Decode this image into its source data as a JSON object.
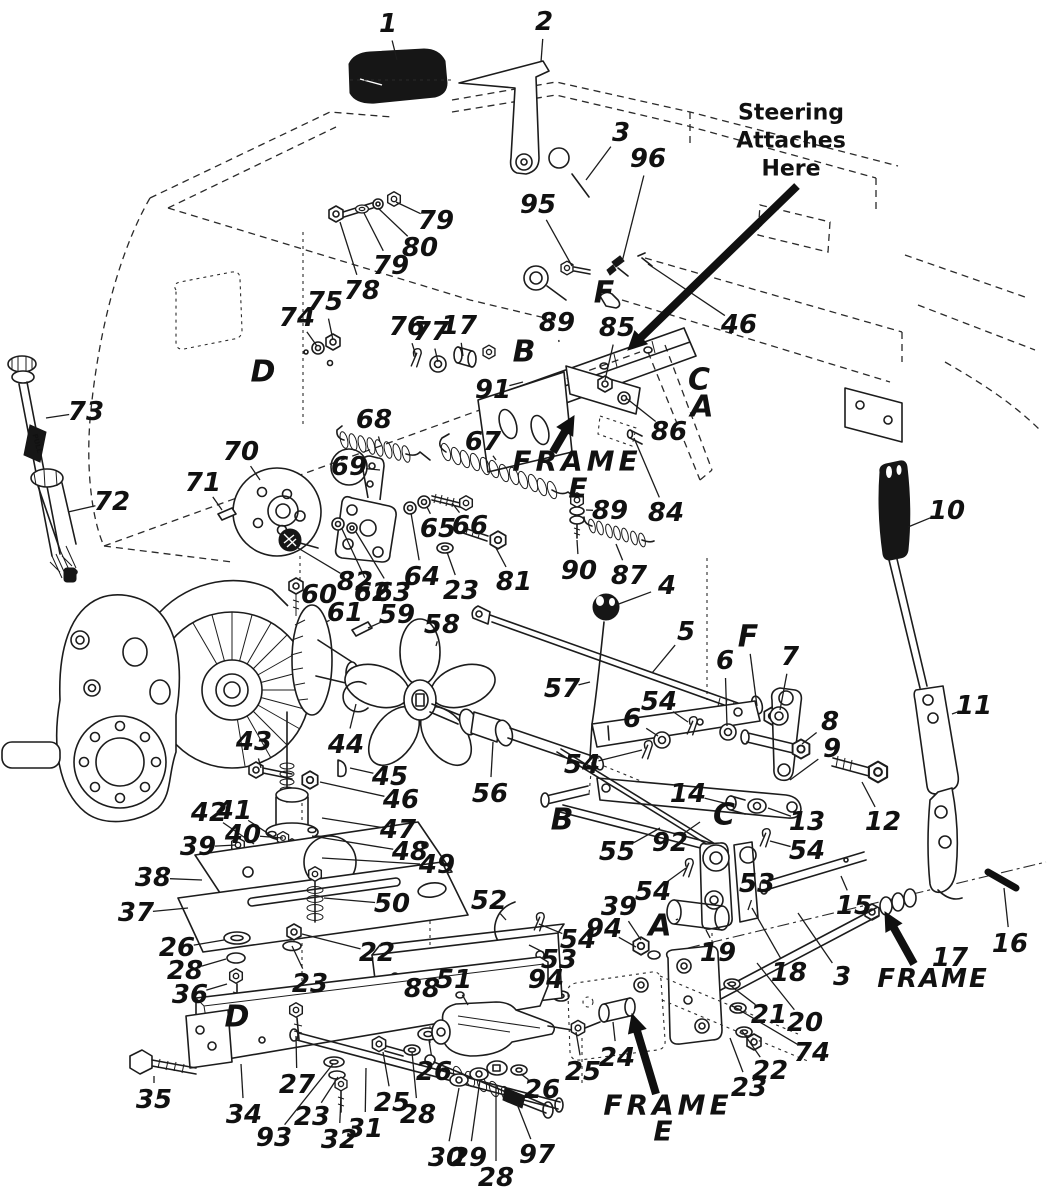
{
  "meta": {
    "doc_type": "exploded-parts-diagram",
    "subject": "tractor drive and speed control linkage",
    "paper_color": "#ffffff",
    "ink_color": "#1c1c1c"
  },
  "extra": {
    "dipstick_tag": "PULL"
  },
  "notes": [
    {
      "id": "steering-note",
      "size": 22,
      "italic": false,
      "spacing": 0,
      "lines": [
        {
          "t": "Steering",
          "x": 791,
          "y": 113
        },
        {
          "t": "Attaches",
          "x": 791,
          "y": 141
        },
        {
          "t": "Here",
          "x": 791,
          "y": 169
        }
      ],
      "arrow": [
        797,
        186,
        628,
        350
      ]
    },
    {
      "id": "frame-e-upper",
      "size": 28,
      "italic": true,
      "spacing": 4,
      "lines": [
        {
          "t": "FRAME",
          "x": 577,
          "y": 461
        },
        {
          "t": "E",
          "x": 580,
          "y": 488
        }
      ],
      "arrow": [
        553,
        452,
        574,
        416
      ]
    },
    {
      "id": "frame-right",
      "size": 26,
      "italic": true,
      "spacing": 2,
      "lines": [
        {
          "t": "FRAME",
          "x": 933,
          "y": 979
        }
      ],
      "arrow": [
        914,
        964,
        885,
        912
      ]
    },
    {
      "id": "frame-e-lower",
      "size": 28,
      "italic": true,
      "spacing": 4,
      "lines": [
        {
          "t": "FRAME",
          "x": 668,
          "y": 1105
        },
        {
          "t": "E",
          "x": 665,
          "y": 1131
        }
      ],
      "arrow": [
        656,
        1094,
        632,
        1014
      ]
    }
  ],
  "ref_letters": [
    {
      "t": "D",
      "x": 263,
      "y": 372
    },
    {
      "t": "B",
      "x": 524,
      "y": 352
    },
    {
      "t": "F",
      "x": 604,
      "y": 293
    },
    {
      "t": "C",
      "x": 699,
      "y": 380
    },
    {
      "t": "A",
      "x": 702,
      "y": 407
    },
    {
      "t": "F",
      "x": 748,
      "y": 637,
      "lead": [
        757,
        706
      ]
    },
    {
      "t": "B",
      "x": 562,
      "y": 820
    },
    {
      "t": "C",
      "x": 724,
      "y": 815
    },
    {
      "t": "A",
      "x": 660,
      "y": 926,
      "lead": [
        678,
        919
      ]
    },
    {
      "t": "D",
      "x": 237,
      "y": 1017
    }
  ],
  "circled": [
    {
      "t": "69",
      "x": 349,
      "y": 467,
      "lead": [
        380,
        470
      ]
    }
  ],
  "part_labels": [
    {
      "t": "1",
      "x": 388,
      "y": 24,
      "lead": [
        397,
        60
      ]
    },
    {
      "t": "2",
      "x": 544,
      "y": 22,
      "lead": [
        541,
        62
      ]
    },
    {
      "t": "3",
      "x": 621,
      "y": 133,
      "lead": [
        586,
        180
      ]
    },
    {
      "t": "96",
      "x": 648,
      "y": 159,
      "lead": [
        622,
        262
      ]
    },
    {
      "t": "95",
      "x": 538,
      "y": 205,
      "lead": [
        572,
        266
      ]
    },
    {
      "t": "79",
      "x": 436,
      "y": 221,
      "lead": [
        396,
        202
      ]
    },
    {
      "t": "80",
      "x": 420,
      "y": 248,
      "lead": [
        378,
        208
      ]
    },
    {
      "t": "79",
      "x": 391,
      "y": 266,
      "lead": [
        364,
        213
      ]
    },
    {
      "t": "78",
      "x": 362,
      "y": 291,
      "lead": [
        340,
        222
      ]
    },
    {
      "t": "75",
      "x": 325,
      "y": 302,
      "lead": [
        333,
        340
      ]
    },
    {
      "t": "74",
      "x": 297,
      "y": 318,
      "lead": [
        317,
        346
      ]
    },
    {
      "t": "76",
      "x": 407,
      "y": 327,
      "lead": [
        416,
        356
      ]
    },
    {
      "t": "77",
      "x": 431,
      "y": 332,
      "lead": [
        438,
        362
      ]
    },
    {
      "t": "17",
      "x": 459,
      "y": 326,
      "lead": [
        463,
        356
      ]
    },
    {
      "t": "89",
      "x": 557,
      "y": 323,
      "lead": [
        559,
        342
      ]
    },
    {
      "t": "85",
      "x": 617,
      "y": 328,
      "lead": [
        605,
        380
      ]
    },
    {
      "t": "46",
      "x": 739,
      "y": 325,
      "lead": [
        648,
        264
      ]
    },
    {
      "t": "91",
      "x": 493,
      "y": 390,
      "lead": [
        523,
        382
      ]
    },
    {
      "t": "86",
      "x": 669,
      "y": 432,
      "lead": [
        626,
        398
      ]
    },
    {
      "t": "73",
      "x": 86,
      "y": 412,
      "lead": [
        46,
        418
      ]
    },
    {
      "t": "68",
      "x": 374,
      "y": 420,
      "lead": [
        380,
        442
      ]
    },
    {
      "t": "67",
      "x": 483,
      "y": 442,
      "lead": [
        496,
        460
      ]
    },
    {
      "t": "70",
      "x": 241,
      "y": 452,
      "lead": [
        260,
        480
      ]
    },
    {
      "t": "71",
      "x": 203,
      "y": 483,
      "lead": [
        222,
        510
      ]
    },
    {
      "t": "72",
      "x": 112,
      "y": 502,
      "lead": [
        68,
        512
      ]
    },
    {
      "t": "84",
      "x": 666,
      "y": 513,
      "lead": [
        634,
        438
      ]
    },
    {
      "t": "89",
      "x": 610,
      "y": 511,
      "lead": [
        586,
        510
      ]
    },
    {
      "t": "90",
      "x": 579,
      "y": 571,
      "lead": [
        577,
        540
      ]
    },
    {
      "t": "87",
      "x": 629,
      "y": 576,
      "lead": [
        616,
        544
      ]
    },
    {
      "t": "10",
      "x": 947,
      "y": 511,
      "lead": [
        908,
        527
      ]
    },
    {
      "t": "65",
      "x": 438,
      "y": 529,
      "lead": [
        427,
        507
      ]
    },
    {
      "t": "66",
      "x": 470,
      "y": 526,
      "lead": [
        452,
        503
      ]
    },
    {
      "t": "64",
      "x": 422,
      "y": 577,
      "lead": [
        411,
        513
      ]
    },
    {
      "t": "23",
      "x": 461,
      "y": 591,
      "lead": [
        447,
        552
      ]
    },
    {
      "t": "81",
      "x": 514,
      "y": 582,
      "lead": [
        496,
        548
      ]
    },
    {
      "t": "82",
      "x": 355,
      "y": 582,
      "lead": [
        298,
        548
      ]
    },
    {
      "t": "62",
      "x": 372,
      "y": 593,
      "lead": [
        342,
        529
      ]
    },
    {
      "t": "63",
      "x": 393,
      "y": 593,
      "lead": [
        356,
        532
      ]
    },
    {
      "t": "60",
      "x": 319,
      "y": 595,
      "lead": [
        302,
        594
      ]
    },
    {
      "t": "61",
      "x": 345,
      "y": 613,
      "lead": [
        326,
        622
      ]
    },
    {
      "t": "59",
      "x": 397,
      "y": 615,
      "lead": [
        368,
        628
      ]
    },
    {
      "t": "58",
      "x": 442,
      "y": 625,
      "lead": [
        436,
        646
      ]
    },
    {
      "t": "4",
      "x": 667,
      "y": 586,
      "lead": [
        616,
        605
      ]
    },
    {
      "t": "5",
      "x": 686,
      "y": 632,
      "lead": [
        652,
        673
      ]
    },
    {
      "t": "57",
      "x": 562,
      "y": 689,
      "lead": [
        590,
        682
      ]
    },
    {
      "t": "6",
      "x": 725,
      "y": 661,
      "lead": [
        727,
        726
      ]
    },
    {
      "t": "7",
      "x": 790,
      "y": 657,
      "lead": [
        780,
        710
      ]
    },
    {
      "t": "54",
      "x": 659,
      "y": 702,
      "lead": [
        688,
        722
      ]
    },
    {
      "t": "6",
      "x": 632,
      "y": 719,
      "lead": [
        658,
        736
      ]
    },
    {
      "t": "8",
      "x": 830,
      "y": 722,
      "lead": [
        802,
        744
      ]
    },
    {
      "t": "9",
      "x": 832,
      "y": 749,
      "lead": [
        790,
        780
      ]
    },
    {
      "t": "11",
      "x": 974,
      "y": 706,
      "lead": [
        952,
        714
      ]
    },
    {
      "t": "54",
      "x": 582,
      "y": 765,
      "lead": [
        642,
        750
      ]
    },
    {
      "t": "14",
      "x": 688,
      "y": 794,
      "lead": [
        728,
        804
      ]
    },
    {
      "t": "13",
      "x": 807,
      "y": 822,
      "lead": [
        768,
        808
      ]
    },
    {
      "t": "12",
      "x": 883,
      "y": 822,
      "lead": [
        862,
        782
      ]
    },
    {
      "t": "56",
      "x": 490,
      "y": 794,
      "lead": [
        493,
        742
      ]
    },
    {
      "t": "55",
      "x": 617,
      "y": 852,
      "lead": [
        660,
        828
      ]
    },
    {
      "t": "92",
      "x": 670,
      "y": 843,
      "lead": [
        700,
        822
      ]
    },
    {
      "t": "43",
      "x": 254,
      "y": 742,
      "lead": [
        261,
        768
      ]
    },
    {
      "t": "44",
      "x": 346,
      "y": 745,
      "lead": [
        356,
        704
      ]
    },
    {
      "t": "45",
      "x": 390,
      "y": 777,
      "lead": [
        350,
        768
      ]
    },
    {
      "t": "46",
      "x": 401,
      "y": 800,
      "lead": [
        320,
        782
      ]
    },
    {
      "t": "42",
      "x": 209,
      "y": 813,
      "lead": [
        254,
        844
      ]
    },
    {
      "t": "41",
      "x": 234,
      "y": 811,
      "lead": [
        278,
        840
      ]
    },
    {
      "t": "40",
      "x": 243,
      "y": 835,
      "lead": [
        283,
        838
      ]
    },
    {
      "t": "39",
      "x": 198,
      "y": 847,
      "lead": [
        236,
        845
      ]
    },
    {
      "t": "47",
      "x": 398,
      "y": 830,
      "lead": [
        322,
        818
      ]
    },
    {
      "t": "48",
      "x": 410,
      "y": 852,
      "lead": [
        312,
        836
      ]
    },
    {
      "t": "49",
      "x": 437,
      "y": 865,
      "lead": [
        322,
        858
      ]
    },
    {
      "t": "38",
      "x": 153,
      "y": 878,
      "lead": [
        202,
        880
      ]
    },
    {
      "t": "37",
      "x": 136,
      "y": 913,
      "lead": [
        188,
        908
      ]
    },
    {
      "t": "50",
      "x": 392,
      "y": 904,
      "lead": [
        324,
        898
      ]
    },
    {
      "t": "26",
      "x": 177,
      "y": 948,
      "lead": [
        224,
        940
      ]
    },
    {
      "t": "28",
      "x": 185,
      "y": 971,
      "lead": [
        226,
        959
      ]
    },
    {
      "t": "36",
      "x": 190,
      "y": 995,
      "lead": [
        227,
        984
      ]
    },
    {
      "t": "22",
      "x": 377,
      "y": 953,
      "lead": [
        302,
        934
      ]
    },
    {
      "t": "23",
      "x": 310,
      "y": 984,
      "lead": [
        292,
        946
      ]
    },
    {
      "t": "88",
      "x": 422,
      "y": 989
    },
    {
      "t": "51",
      "x": 454,
      "y": 980,
      "lead": [
        468,
        1005
      ]
    },
    {
      "t": "52",
      "x": 489,
      "y": 901,
      "lead": [
        506,
        920
      ]
    },
    {
      "t": "54",
      "x": 578,
      "y": 940,
      "lead": [
        539,
        924
      ]
    },
    {
      "t": "53",
      "x": 559,
      "y": 960,
      "lead": [
        529,
        945
      ]
    },
    {
      "t": "39",
      "x": 619,
      "y": 907,
      "lead": [
        641,
        940
      ]
    },
    {
      "t": "94",
      "x": 604,
      "y": 929,
      "lead": [
        636,
        947
      ]
    },
    {
      "t": "94",
      "x": 546,
      "y": 980,
      "lead": [
        557,
        993
      ]
    },
    {
      "t": "19",
      "x": 718,
      "y": 953,
      "lead": [
        706,
        930
      ]
    },
    {
      "t": "53",
      "x": 757,
      "y": 884,
      "lead": [
        748,
        910
      ]
    },
    {
      "t": "54",
      "x": 653,
      "y": 892,
      "lead": [
        686,
        868
      ]
    },
    {
      "t": "54",
      "x": 807,
      "y": 851,
      "lead": [
        770,
        841
      ]
    },
    {
      "t": "18",
      "x": 789,
      "y": 973,
      "lead": [
        752,
        908
      ]
    },
    {
      "t": "3",
      "x": 842,
      "y": 977,
      "lead": [
        798,
        913
      ]
    },
    {
      "t": "15",
      "x": 854,
      "y": 906,
      "lead": [
        841,
        876
      ]
    },
    {
      "t": "16",
      "x": 1010,
      "y": 944,
      "lead": [
        1004,
        888
      ]
    },
    {
      "t": "17",
      "x": 950,
      "y": 958
    },
    {
      "t": "20",
      "x": 805,
      "y": 1023,
      "lead": [
        757,
        963
      ]
    },
    {
      "t": "21",
      "x": 769,
      "y": 1015,
      "lead": [
        727,
        983
      ]
    },
    {
      "t": "74",
      "x": 812,
      "y": 1053,
      "lead": [
        731,
        1005
      ]
    },
    {
      "t": "22",
      "x": 770,
      "y": 1071,
      "lead": [
        742,
        1031
      ]
    },
    {
      "t": "23",
      "x": 749,
      "y": 1088,
      "lead": [
        730,
        1038
      ]
    },
    {
      "t": "24",
      "x": 617,
      "y": 1058,
      "lead": [
        613,
        1022
      ]
    },
    {
      "t": "25",
      "x": 583,
      "y": 1072,
      "lead": [
        576,
        1032
      ]
    },
    {
      "t": "26",
      "x": 542,
      "y": 1090,
      "lead": [
        521,
        1074
      ]
    },
    {
      "t": "97",
      "x": 537,
      "y": 1155,
      "lead": [
        517,
        1104
      ]
    },
    {
      "t": "30",
      "x": 446,
      "y": 1158,
      "lead": [
        459,
        1088
      ]
    },
    {
      "t": "29",
      "x": 469,
      "y": 1158,
      "lead": [
        480,
        1080
      ]
    },
    {
      "t": "28",
      "x": 496,
      "y": 1178,
      "lead": [
        496,
        1086
      ]
    },
    {
      "t": "26",
      "x": 434,
      "y": 1072,
      "lead": [
        429,
        1040
      ]
    },
    {
      "t": "28",
      "x": 418,
      "y": 1115,
      "lead": [
        412,
        1052
      ]
    },
    {
      "t": "25",
      "x": 392,
      "y": 1103,
      "lead": [
        383,
        1052
      ]
    },
    {
      "t": "31",
      "x": 365,
      "y": 1129,
      "lead": [
        366,
        1068
      ]
    },
    {
      "t": "32",
      "x": 339,
      "y": 1140,
      "lead": [
        341,
        1097
      ]
    },
    {
      "t": "23",
      "x": 312,
      "y": 1117,
      "lead": [
        338,
        1077
      ]
    },
    {
      "t": "93",
      "x": 274,
      "y": 1138,
      "lead": [
        333,
        1064
      ]
    },
    {
      "t": "27",
      "x": 297,
      "y": 1085,
      "lead": [
        296,
        1036
      ]
    },
    {
      "t": "34",
      "x": 244,
      "y": 1115,
      "lead": [
        241,
        1064
      ]
    },
    {
      "t": "35",
      "x": 154,
      "y": 1100,
      "lead": [
        154,
        1076
      ]
    }
  ]
}
